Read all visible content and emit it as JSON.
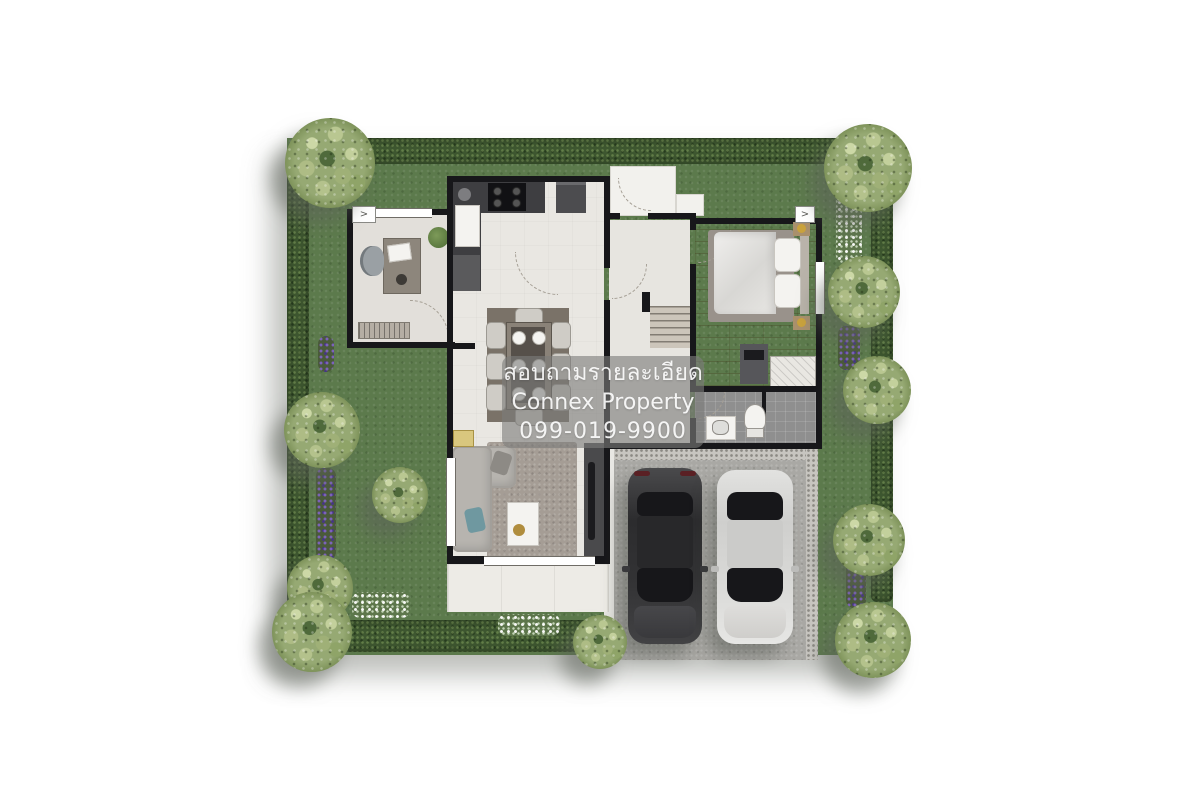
{
  "watermark": {
    "line1": "สอบถามรายละเอียด",
    "line2": "Connex Property",
    "line3": "099-019-9900"
  },
  "markers": {
    "office_entry_arrow": ">",
    "bedroom_entry_arrow": ">"
  },
  "palette": {
    "grass": "#5c7a4c",
    "hedge": "#3e5730",
    "tree": "#96a973",
    "floor": "#e9e7e2",
    "wood_floor": "#b2946f",
    "bath_floor": "#8f8f8f",
    "driveway": "#a9a8a4",
    "terrace": "#edebe6",
    "wall": "#17171a",
    "car_dark": "#333335",
    "car_silver": "#d9d9d7",
    "watermark_bg": "#7d7d7a",
    "watermark_text": "#ffffff",
    "flowers_purple": "#7a64c8",
    "flowers_white": "#ffffff"
  }
}
